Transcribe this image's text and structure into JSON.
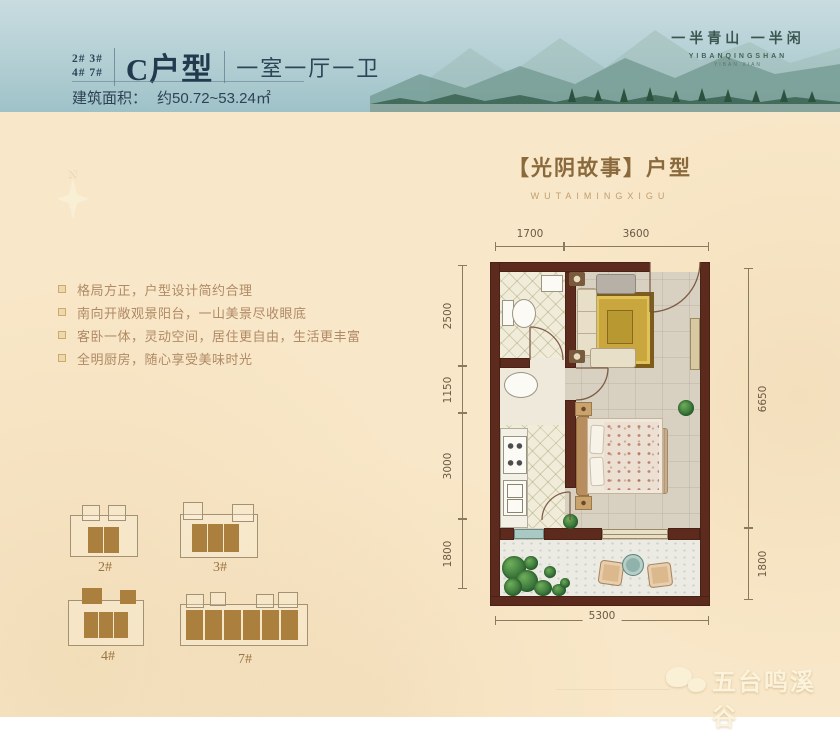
{
  "header": {
    "units_line1": "2# 3#",
    "units_line2": "4# 7#",
    "unit_name": "C户型",
    "layout_desc": "一室一厅一卫",
    "area_label": "建筑面积：",
    "area_value": "约50.72~53.24㎡",
    "brand_slogan": "一半青山 一半闲",
    "brand_en": "YIBANQINGSHAN",
    "brand_en_sub": "YIBAN XIAN"
  },
  "compass": {
    "label": "N"
  },
  "section_title": {
    "main": "【光阴故事】户型",
    "sub": "WUTAIMINGXIGU"
  },
  "features": [
    {
      "text": "格局方正，户型设计简约合理"
    },
    {
      "text": "南向开敞观景阳台，一山美景尽收眼底"
    },
    {
      "text": "客卧一体，灵动空间，居住更自由，生活更丰富"
    },
    {
      "text": "全明厨房，随心享受美味时光"
    }
  ],
  "floorplan": {
    "dims_top": [
      "1700",
      "3600"
    ],
    "dims_left": [
      "2500",
      "1150",
      "3000",
      "1800"
    ],
    "dims_right": [
      "6650",
      "1800"
    ],
    "dims_bottom": [
      "5300"
    ]
  },
  "buildings": [
    {
      "label": "2#"
    },
    {
      "label": "3#"
    },
    {
      "label": "4#"
    },
    {
      "label": "7#"
    }
  ],
  "footer": {
    "logo_text": "五台鸣溪谷"
  },
  "colors": {
    "header_blue": "#aecdd2",
    "cream_bg": "#f8e7c8",
    "wall_brown": "#5d2b1e",
    "gold_accent": "#8a6a3c",
    "unit_brown": "#ab7f3e",
    "rug_gold": "#c9a63e"
  }
}
